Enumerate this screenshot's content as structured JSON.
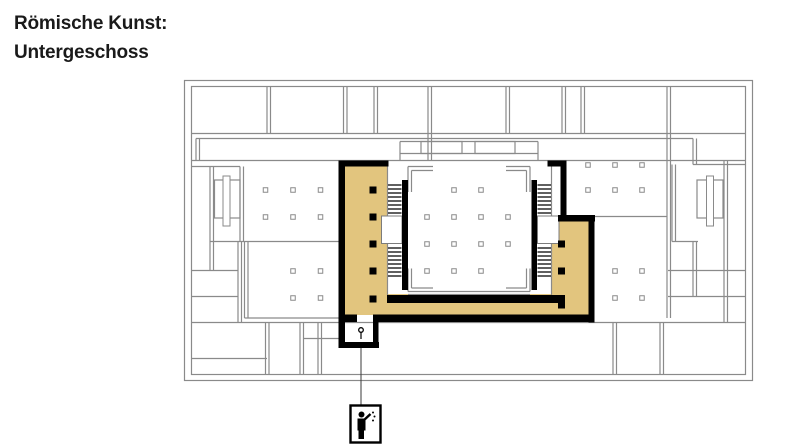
{
  "title": {
    "line1": "Römische Kunst:",
    "line2": "Untergeschoss"
  },
  "plan": {
    "colors": {
      "highlight": "#e2c57e",
      "wall": "#8a8a8a",
      "emphasis": "#000000",
      "background": "#ffffff",
      "leader": "#3a3a3a",
      "title_text": "#1a1a1a"
    },
    "icons": [
      {
        "name": "visitor-pictogram-icon"
      },
      {
        "name": "stairs-icon"
      },
      {
        "name": "escalator-icon"
      },
      {
        "name": "entrance-marker-icon"
      }
    ]
  }
}
